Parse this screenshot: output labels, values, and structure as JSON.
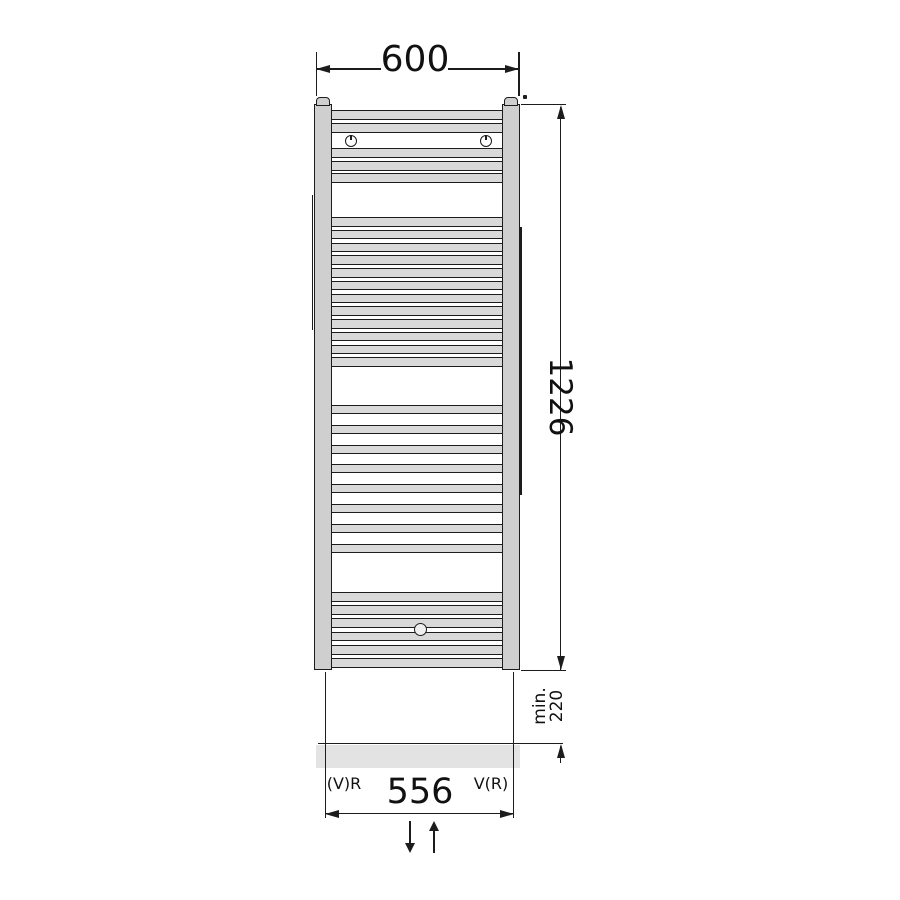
{
  "drawing": {
    "type": "technical-dimension-drawing",
    "subject": "towel radiator front view"
  },
  "dimensions": {
    "width_label": "600",
    "height_label": "1226",
    "floor_clearance_label": "min. 220",
    "connection_spacing_label": "556"
  },
  "connection_labels": {
    "left": "(V)R",
    "right": "V(R)"
  },
  "colors": {
    "line": "#1c1c1c",
    "tube_fill": "#d9d9d9",
    "column_fill": "#cfcfcf",
    "floor_fill": "#e3e3e3",
    "text": "#111111",
    "background": "#ffffff"
  },
  "radiator": {
    "tube_groups": [
      {
        "name": "top-group-upper-pair",
        "start_y": 110,
        "count": 2,
        "pitch": 13,
        "tube_height": 10
      },
      {
        "name": "top-group-lower-trio",
        "start_y": 148,
        "count": 3,
        "pitch": 12.5,
        "tube_height": 10
      },
      {
        "name": "upper-middle-group",
        "start_y": 217,
        "count": 12,
        "pitch": 12.75,
        "tube_height": 9.5
      },
      {
        "name": "lower-middle-group",
        "start_y": 405,
        "count": 8,
        "pitch": 19.8,
        "tube_height": 9
      },
      {
        "name": "bottom-group",
        "start_y": 592,
        "count": 6,
        "pitch": 13.2,
        "tube_height": 9.8
      }
    ]
  }
}
